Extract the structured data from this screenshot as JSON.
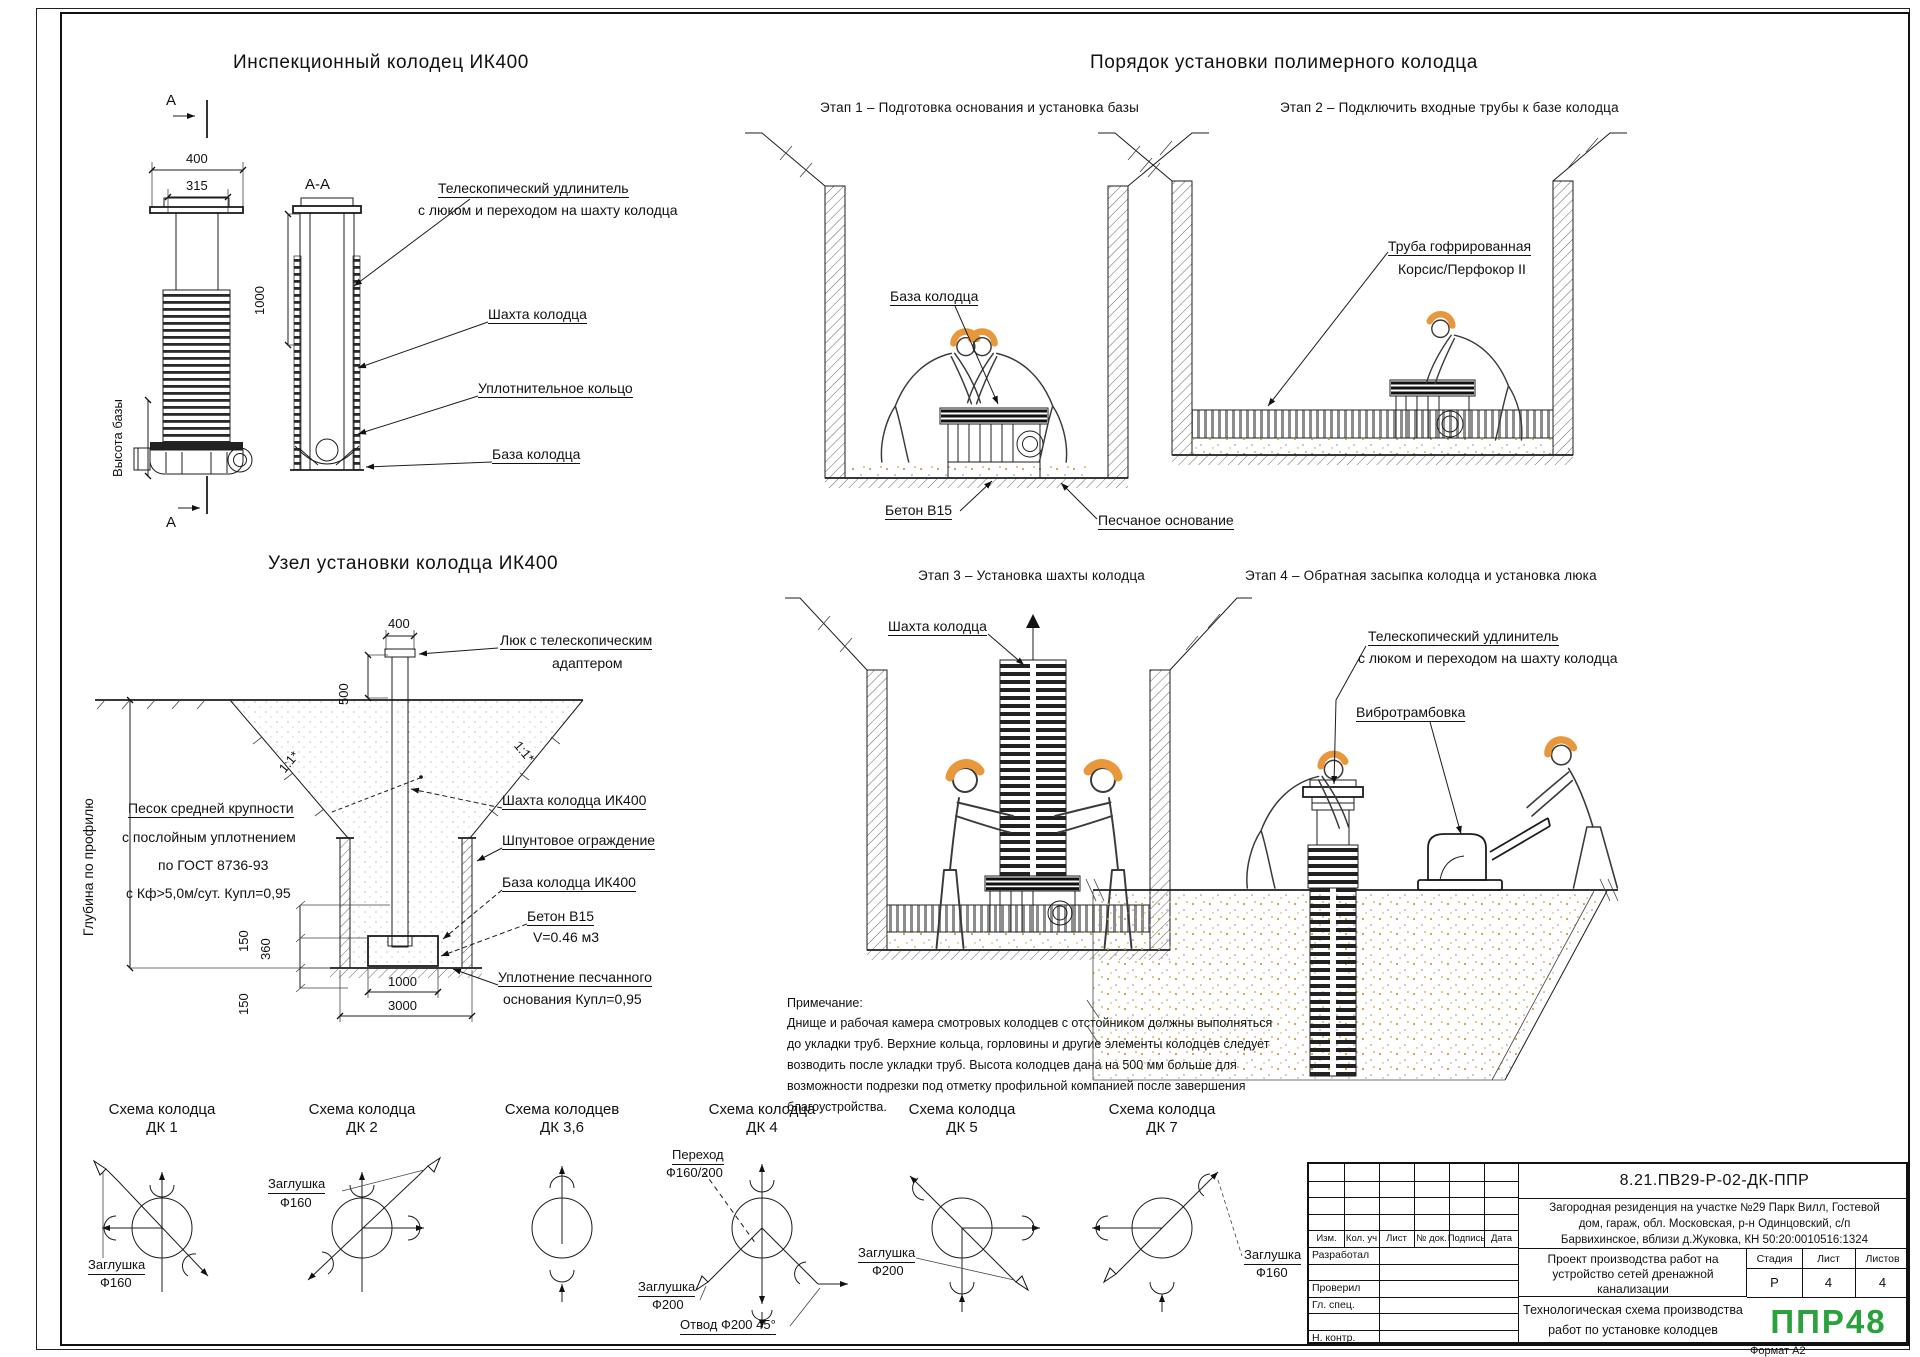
{
  "page": {
    "format_label": "Формат А2"
  },
  "sec1": {
    "title": "Инспекционный колодец ИК400",
    "section_mark": "А",
    "section_view_label": "А-А",
    "dim_400": "400",
    "dim_315": "315",
    "dim_1000": "1000",
    "base_height_label": "Высота базы",
    "label_telescopic_1": "Телескопический удлинитель",
    "label_telescopic_2": "с люком и переходом на шахту колодца",
    "label_shaft": "Шахта колодца",
    "label_oring": "Уплотнительное кольцо",
    "label_base": "База колодца"
  },
  "sec2": {
    "title": "Узел установки колодца ИК400",
    "dim_400": "400",
    "dim_500": "500",
    "dim_150a": "150",
    "dim_360": "360",
    "dim_150b": "150",
    "dim_1000": "1000",
    "dim_3000": "3000",
    "slope_left": "1:1*",
    "slope_right": "1:1*",
    "depth_label": "Глубина по профилю",
    "sand_line_1": "Песок средней крупности",
    "sand_line_2": "с послойным уплотнением",
    "sand_line_3": "по ГОСТ 8736-93",
    "sand_line_4": "с Кф>5,0м/сут. Купл=0,95",
    "label_hatch_1": "Люк с телескопическим",
    "label_hatch_2": "адаптером",
    "label_shaft": "Шахта колодца ИК400",
    "label_sheet_pile": "Шпунтовое ограждение",
    "label_base": "База колодца ИК400",
    "label_concrete_1": "Бетон В15",
    "label_concrete_2": "V=0.46 м3",
    "label_seal_1": "Уплотнение песчанного",
    "label_seal_2": "основания Купл=0,95"
  },
  "sec3": {
    "title": "Порядок установки полимерного колодца",
    "stage1": {
      "title": "Этап 1 – Подготовка основания и установка базы",
      "label_base": "База колодца",
      "label_concrete": "Бетон В15",
      "label_sand": "Песчаное основание"
    },
    "stage2": {
      "title": "Этап 2 – Подключить входные трубы к базе колодца",
      "label_pipe_1": "Труба гофрированная",
      "label_pipe_2": "Корсис/Перфокор II"
    },
    "stage3": {
      "title": "Этап 3 – Установка шахты колодца",
      "label_shaft": "Шахта колодца"
    },
    "stage4": {
      "title": "Этап 4 – Обратная засыпка колодца и установка люка",
      "label_tel_1": "Телескопический удлинитель",
      "label_tel_2": "с люком и переходом на шахту колодца",
      "label_vibro": "Вибротрамбовка"
    }
  },
  "note": {
    "title": "Примечание:",
    "lines": [
      "Днище и рабочая камера смотровых колодцев с отстойником должны выполняться",
      "до укладки труб. Верхние кольца, горловины и другие элементы колодцев следует",
      "возводить после укладки труб. Высота колодцев дана на 500 мм больше для",
      "возможности подрезки под отметку профильной компанией после завершения",
      "благоустройства."
    ]
  },
  "schematics": [
    {
      "t1": "Схема колодца",
      "t2": "ДК 1",
      "lab1a": "Заглушка",
      "lab1b": "Ф160"
    },
    {
      "t1": "Схема колодца",
      "t2": "ДК 2",
      "lab1a": "Заглушка",
      "lab1b": "Ф160"
    },
    {
      "t1": "Схема колодцев",
      "t2": "ДК 3,6"
    },
    {
      "t1": "Схема колодца",
      "t2": "ДК 4",
      "lab1a": "Переход",
      "lab1b": "Ф160/200",
      "lab2a": "Заглушка",
      "lab2b": "Ф200",
      "lab3": "Отвод Ф200 45°"
    },
    {
      "t1": "Схема колодца",
      "t2": "ДК 5",
      "lab1a": "Заглушка",
      "lab1b": "Ф200"
    },
    {
      "t1": "Схема колодца",
      "t2": "ДК 7",
      "lab1a": "Заглушка",
      "lab1b": "Ф160"
    }
  ],
  "title_block": {
    "doc_number": "8.21.ПВ29-Р-02-ДК-ППР",
    "project_line_1": "Загородная резиденция на участке №29 Парк Вилл, Гостевой",
    "project_line_2": "дом, гараж, обл. Московская, р-н Одинцовский, с/п",
    "project_line_3": "Барвихинское, вблизи д.Жуковка, КН 50:20:0010516:1324",
    "work_line_1": "Проект производства работ на",
    "work_line_2": "устройство сетей дренажной",
    "work_line_3": "канализации",
    "sheet_title_1": "Технологическая схема производства",
    "sheet_title_2": "работ по установке колодцев",
    "cols": [
      "Изм.",
      "Кол. уч",
      "Лист",
      "№ док.",
      "Подпись",
      "Дата"
    ],
    "rows": [
      "Разработал",
      "",
      "Проверил",
      "Гл. спец.",
      "",
      "Н. контр."
    ],
    "stage_h": "Стадия",
    "sheet_h": "Лист",
    "sheets_h": "Листов",
    "stage_v": "Р",
    "sheet_v": "4",
    "sheets_v": "4",
    "logo": "ППР48",
    "logo_color": "#2BA13C"
  }
}
